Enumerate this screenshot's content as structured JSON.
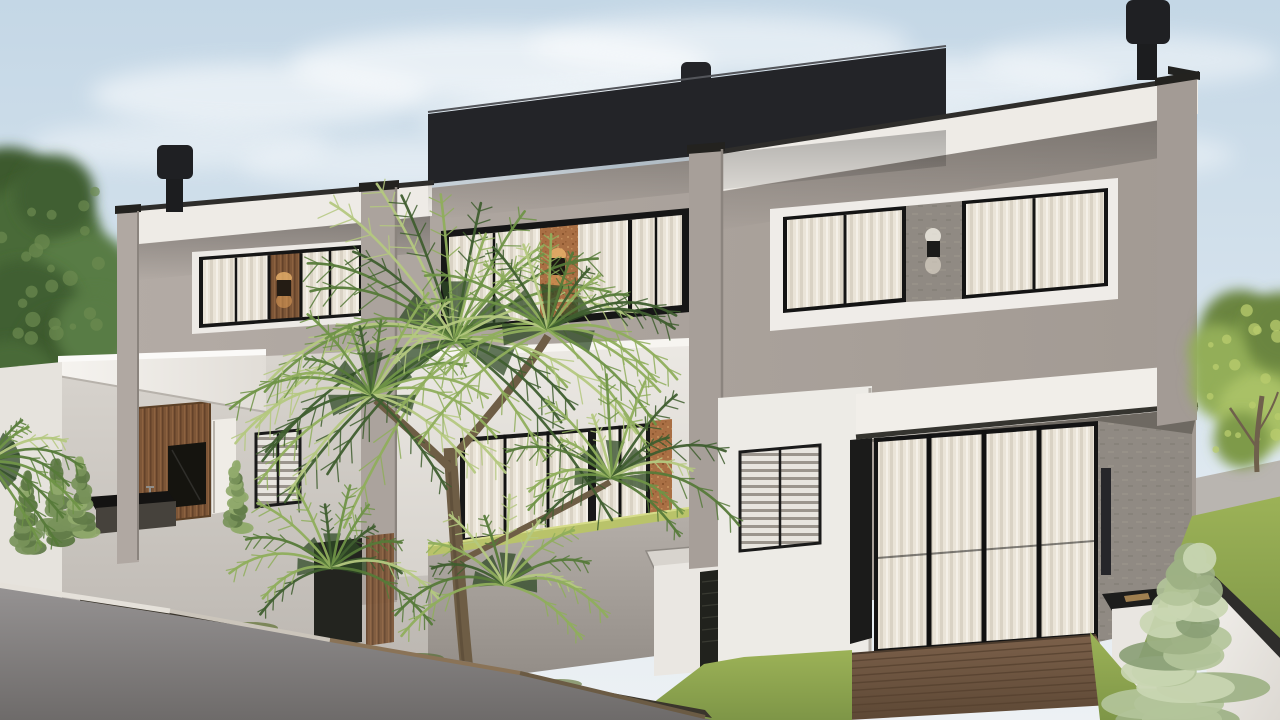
{
  "meta": {
    "type": "architectural-render",
    "description": "Photorealistic 3D exterior rendering of a modern two-story triplex townhouse in greige stucco with a black rooftop volume, three horizontal upper windows with sheer curtains and wall sconces, ground-floor glass sliding doors, wood and copper accent panels, a large fan palm in the front courtyard, perimeter walls, lawns and ornamental shrubs under a pale blue sky."
  },
  "palette": {
    "sky_top": "#c4d7e6",
    "sky_mid": "#d9e5ee",
    "sky_low": "#edf1f4",
    "cloud": "#ffffff",
    "facade": "#aba39d",
    "fascia_white": "#eeebe6",
    "coping_black": "#2e2d2b",
    "roof_black": "#232428",
    "chimney_black": "#1c1d1f",
    "frame_black": "#161616",
    "curtain": "#eae4d8",
    "wood": "#7d5637",
    "copper": "#a96f44",
    "concrete": "#908a83",
    "canopy_white": "#f4f1ec",
    "courtyard_gray": "#c9c4be",
    "mid_wall_white": "#eae7e2",
    "parapet_gray": "#aaa49e",
    "grass_hedge": "#b9c36a",
    "lawn_green": "#8ca24d",
    "deck_brown": "#6f5640",
    "foreground_wall": "#8d8a88",
    "right_wall_white": "#f2f0ec",
    "utility_dark": "#23241f",
    "sconce_glow_warm": "#e8b26a",
    "palm_greens": [
      "#2f4a26",
      "#3f5e2f",
      "#567a39",
      "#6f9347",
      "#8fae5c",
      "#b4c87f"
    ],
    "left_tree_greens": [
      "#3c5a2e",
      "#4a6b38",
      "#587c44",
      "#405f31"
    ],
    "right_tree_greens": [
      "#6a853f",
      "#7e9a4a",
      "#93ae58",
      "#a9c166"
    ],
    "cypress_greens": [
      "#5f7a46",
      "#78935a",
      "#91aa6c"
    ],
    "juniper_greens": [
      "#9db184",
      "#b3c49a",
      "#c9d6b2",
      "#8aa076"
    ]
  },
  "objects": [
    "sky",
    "clouds",
    "left-trees",
    "townhouse-building",
    "rooftop-volume",
    "chimney-left",
    "chimney-middle",
    "chimney-right",
    "upper-window-left",
    "upper-window-middle",
    "upper-window-right",
    "wall-sconce",
    "entry-canopy",
    "wood-entry-panel",
    "outdoor-counter",
    "louver-window",
    "glass-sliding-doors",
    "copper-accent-panel",
    "concrete-accent-wall",
    "patio-deck",
    "bbq-counter",
    "utility-box",
    "hedge-parapet",
    "palm-tree",
    "cypress-plants",
    "juniper-shrub",
    "right-tree",
    "front-lawn",
    "side-lawn",
    "foreground-wall",
    "right-perimeter-wall"
  ],
  "vegetation": {
    "clouds": [
      [
        260,
        95,
        170,
        32,
        0.55
      ],
      [
        500,
        65,
        210,
        36,
        0.6
      ],
      [
        720,
        45,
        190,
        30,
        0.5
      ],
      [
        950,
        85,
        170,
        28,
        0.5
      ],
      [
        1130,
        60,
        150,
        26,
        0.45
      ],
      [
        180,
        145,
        150,
        24,
        0.4
      ],
      [
        830,
        135,
        210,
        30,
        0.45
      ],
      [
        1060,
        155,
        175,
        26,
        0.4
      ],
      [
        420,
        165,
        180,
        26,
        0.4
      ],
      [
        640,
        120,
        220,
        34,
        0.5
      ]
    ],
    "left_tree_blobs": [
      [
        8,
        205,
        58
      ],
      [
        40,
        240,
        62
      ],
      [
        82,
        285,
        55
      ],
      [
        25,
        320,
        60
      ],
      [
        65,
        355,
        48
      ],
      [
        12,
        390,
        50
      ],
      [
        95,
        330,
        40
      ],
      [
        55,
        195,
        40
      ]
    ],
    "right_tree_blobs": [
      [
        1240,
        330,
        40
      ],
      [
        1268,
        358,
        46
      ],
      [
        1226,
        384,
        36
      ],
      [
        1258,
        412,
        40
      ],
      [
        1282,
        330,
        38
      ],
      [
        1242,
        440,
        28
      ],
      [
        1216,
        352,
        28
      ]
    ],
    "palm_rosettes": [
      {
        "cx": 455,
        "cy": 340,
        "n": 30,
        "l0": 110,
        "l1": 215,
        "a0": -230,
        "a1": 50
      },
      {
        "cx": 372,
        "cy": 395,
        "n": 20,
        "l0": 80,
        "l1": 150,
        "a0": -220,
        "a1": 40
      },
      {
        "cx": 548,
        "cy": 330,
        "n": 20,
        "l0": 85,
        "l1": 160,
        "a0": -210,
        "a1": 40
      },
      {
        "cx": 612,
        "cy": 478,
        "n": 16,
        "l0": 70,
        "l1": 130,
        "a0": -200,
        "a1": 30
      },
      {
        "cx": 332,
        "cy": 568,
        "n": 14,
        "l0": 65,
        "l1": 115,
        "a0": -200,
        "a1": 20
      },
      {
        "cx": 505,
        "cy": 585,
        "n": 13,
        "l0": 60,
        "l1": 110,
        "a0": -190,
        "a1": 20
      },
      {
        "cx": -12,
        "cy": 462,
        "n": 9,
        "l0": 60,
        "l1": 105,
        "a0": -60,
        "a1": 55
      }
    ],
    "cypresses": [
      {
        "cx": 26,
        "by": 548,
        "h": 78,
        "w": 26
      },
      {
        "cx": 57,
        "by": 540,
        "h": 82,
        "w": 28
      },
      {
        "cx": 81,
        "by": 532,
        "h": 76,
        "w": 24
      },
      {
        "cx": 236,
        "by": 528,
        "h": 68,
        "w": 22
      }
    ],
    "juniper": {
      "cx": 1190,
      "by": 720,
      "h": 178,
      "w": 130
    },
    "deck_planks": {
      "count": 8
    }
  }
}
